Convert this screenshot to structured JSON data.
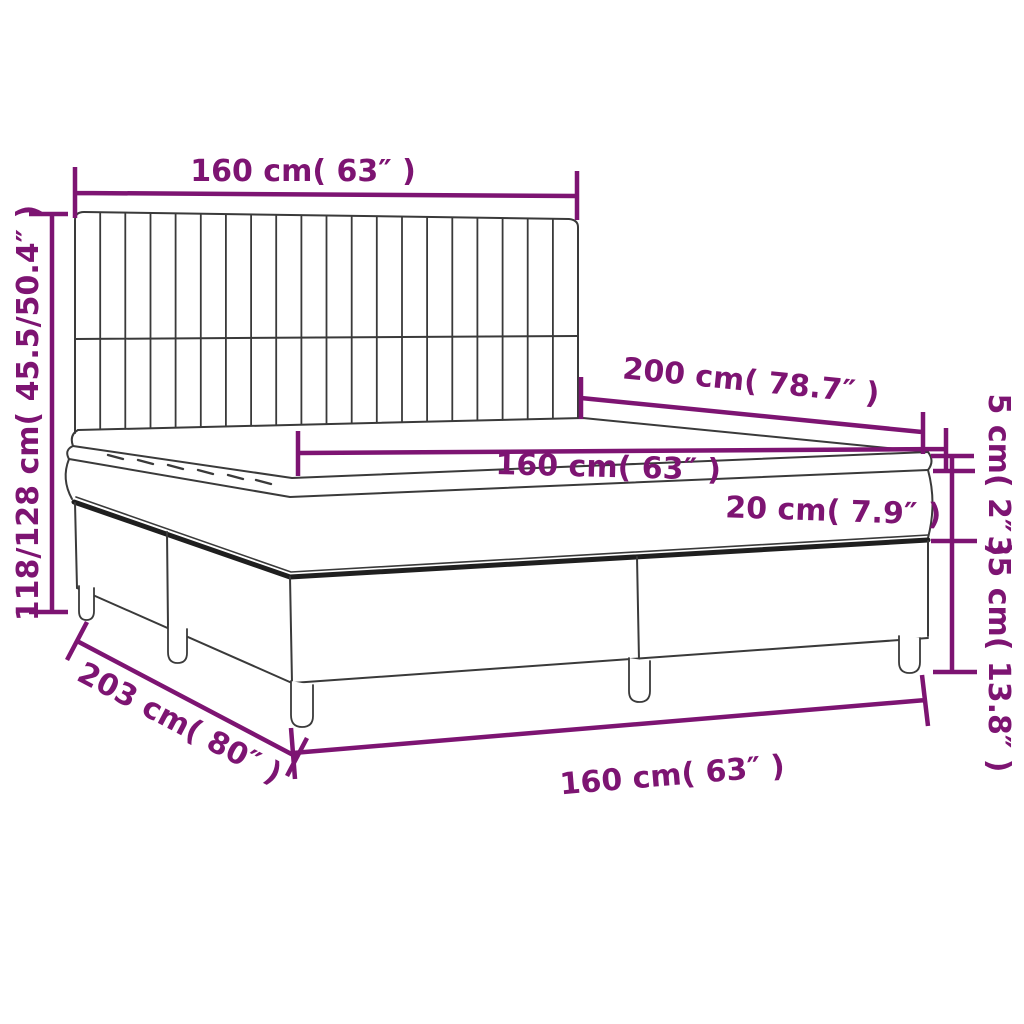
{
  "diagram": {
    "title": "box spring bed dimension diagram",
    "colors": {
      "accent": "#7D1472",
      "line": "#3A3A3A",
      "line_thick": "#1F1F1F",
      "background": "#FFFFFF"
    },
    "labels": {
      "headboard_width_top": "160 cm( 63″ )",
      "headboard_height_left": "118/128 cm( 45.5/50.4″ )",
      "bed_length": "200 cm( 78.7″ )",
      "mattress_width": "160 cm( 63″ )",
      "mattress_thickness": "20 cm( 7.9″ )",
      "topper_thickness": "5 cm( 2″ )",
      "base_height": "35 cm( 13.8″ )",
      "total_length_diagonal": "203 cm( 80″ )",
      "base_width_bottom": "160 cm( 63″ )"
    }
  }
}
